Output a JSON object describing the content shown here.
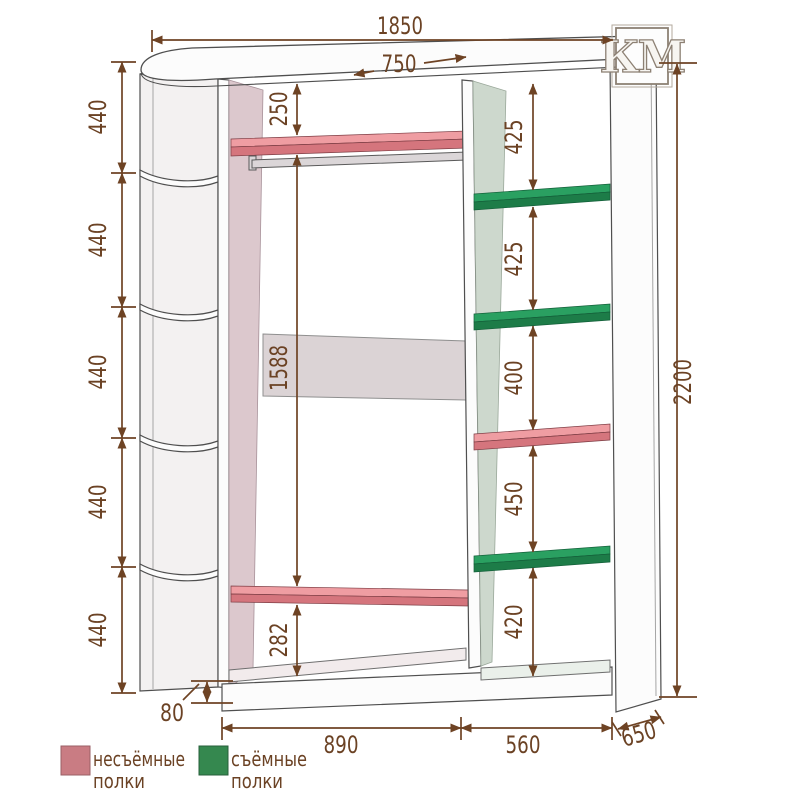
{
  "logo": {
    "text": "КМ"
  },
  "dims": {
    "overall_width": "1850",
    "top_depth": "750",
    "overall_height": "2200",
    "left_gaps": [
      "440",
      "440",
      "440",
      "440",
      "440"
    ],
    "top_to_shelf": "250",
    "middle_height": "1588",
    "shelf_to_bottom": "282",
    "right_gaps": [
      "425",
      "425",
      "400",
      "450",
      "420"
    ],
    "plinth_height": "80",
    "main_width": "890",
    "right_width": "560",
    "depth": "650"
  },
  "legend": {
    "items": [
      {
        "swatch_color": "#c97c83",
        "line1": "несъёмные",
        "line2": "полки"
      },
      {
        "swatch_color": "#35884f",
        "line1": "съёмные",
        "line2": "полки"
      }
    ]
  },
  "colors": {
    "dimension": "#6e4324",
    "outline": "#4f4f4f",
    "fixed_shelf_top": "#ef9da2",
    "fixed_shelf_front": "#d5757d",
    "removable_shelf_top": "#2aa061",
    "removable_shelf_front": "#1d7c48"
  }
}
